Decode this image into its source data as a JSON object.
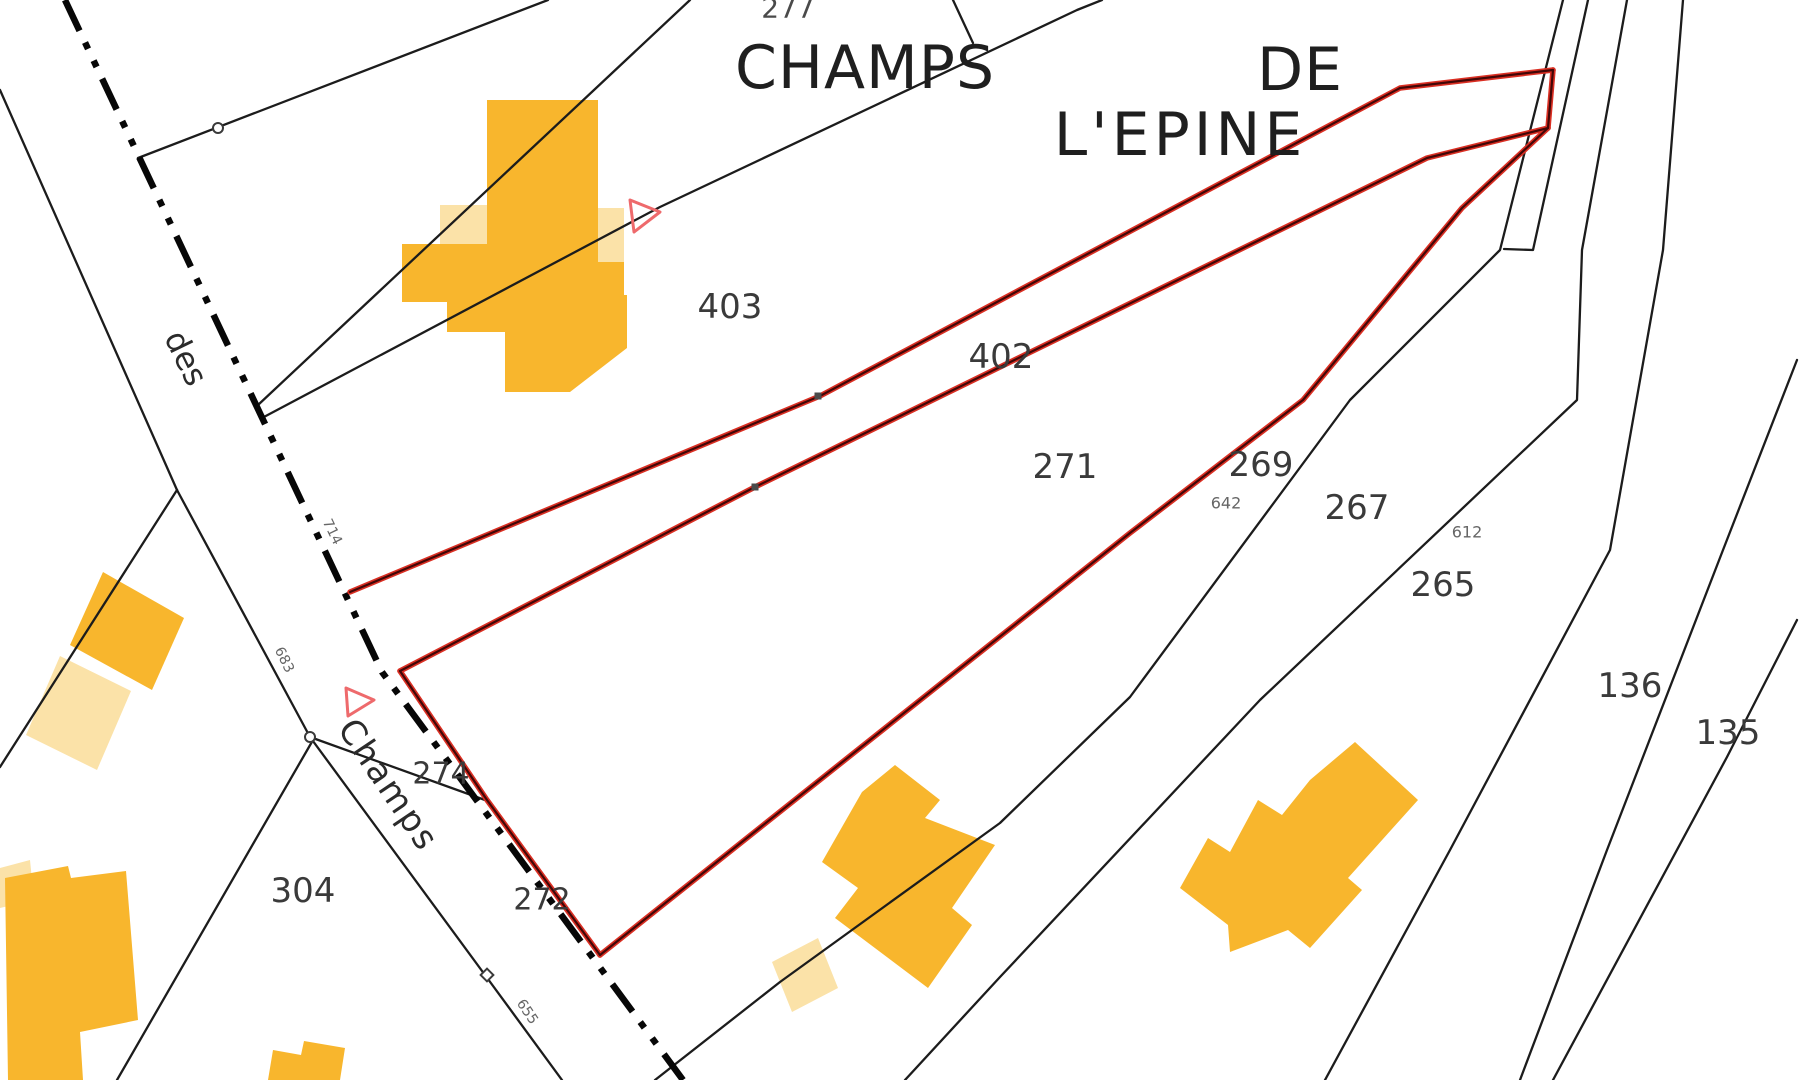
{
  "map": {
    "type": "cadastral-parcel-map",
    "canvas": {
      "width": 1799,
      "height": 1080,
      "background": "#ffffff"
    },
    "colors": {
      "parcel_line": "#1c1c1c",
      "road_dash": "#070707",
      "selected_outer": "#da2f23",
      "selected_inner": "#420707",
      "building_dark": "#F8B62D",
      "building_light": "#FBE2A8",
      "survey_marker": "#ee6a6c",
      "vertex_marker": "#3a3a3a",
      "place_label": "#1f1f1f",
      "parcel_label": "#3a3a3a",
      "ref_label": "#666666"
    },
    "place_labels": [
      {
        "name": "place-label-277",
        "text": "277",
        "x": 788,
        "y": 8,
        "size": 28,
        "color": "#4a4a4a"
      },
      {
        "name": "place-label-champs",
        "text": "CHAMPS",
        "x": 865,
        "y": 68,
        "size": 60,
        "ls": 1,
        "color": "#1f1f1f"
      },
      {
        "name": "place-label-de",
        "text": "DE",
        "x": 1300,
        "y": 70,
        "size": 60,
        "ls": 1,
        "color": "#1f1f1f"
      },
      {
        "name": "place-label-lepine",
        "text": "L'EPINE",
        "x": 1180,
        "y": 135,
        "size": 60,
        "ls": 4,
        "color": "#1f1f1f"
      }
    ],
    "parcel_labels": [
      {
        "name": "parcel-label-403",
        "text": "403",
        "x": 730,
        "y": 307,
        "size": 34
      },
      {
        "name": "parcel-label-402",
        "text": "402",
        "x": 1001,
        "y": 357,
        "size": 34
      },
      {
        "name": "parcel-label-271",
        "text": "271",
        "x": 1065,
        "y": 467,
        "size": 34
      },
      {
        "name": "parcel-label-269",
        "text": "269",
        "x": 1261,
        "y": 465,
        "size": 34
      },
      {
        "name": "parcel-label-267",
        "text": "267",
        "x": 1357,
        "y": 508,
        "size": 34
      },
      {
        "name": "parcel-label-265",
        "text": "265",
        "x": 1443,
        "y": 585,
        "size": 34
      },
      {
        "name": "parcel-label-136",
        "text": "136",
        "x": 1630,
        "y": 686,
        "size": 34
      },
      {
        "name": "parcel-label-135",
        "text": "135",
        "x": 1728,
        "y": 733,
        "size": 34
      },
      {
        "name": "parcel-label-304",
        "text": "304",
        "x": 303,
        "y": 891,
        "size": 34
      },
      {
        "name": "parcel-label-274",
        "text": "274",
        "x": 441,
        "y": 774,
        "size": 30
      },
      {
        "name": "parcel-label-272",
        "text": "272",
        "x": 542,
        "y": 900,
        "size": 30
      }
    ],
    "ref_labels": [
      {
        "name": "ref-label-642",
        "text": "642",
        "x": 1226,
        "y": 503,
        "size": 16,
        "rot": 0
      },
      {
        "name": "ref-label-612",
        "text": "612",
        "x": 1467,
        "y": 532,
        "size": 16,
        "rot": 0
      },
      {
        "name": "ref-label-714",
        "text": "714",
        "x": 332,
        "y": 532,
        "size": 14,
        "rot": 64
      },
      {
        "name": "ref-label-683",
        "text": "683",
        "x": 284,
        "y": 660,
        "size": 14,
        "rot": 64
      },
      {
        "name": "ref-label-655",
        "text": "655",
        "x": 527,
        "y": 1012,
        "size": 14,
        "rot": 56
      }
    ],
    "road_labels": [
      {
        "name": "road-label-des",
        "text": "des",
        "x": 186,
        "y": 358,
        "size": 32,
        "rot": 64,
        "color": "#2b2b2b"
      },
      {
        "name": "road-label-champs",
        "text": "Champs",
        "x": 388,
        "y": 785,
        "size": 34,
        "rot": 56,
        "color": "#2b2b2b",
        "ls": 2
      }
    ],
    "geometry": {
      "road_centerline": {
        "points": [
          [
            65,
            0
          ],
          [
            382,
            672
          ],
          [
            683,
            1080
          ]
        ],
        "width": 6.5,
        "dash": "34 13 7 13 7 13"
      },
      "parcel_lines": [
        [
          [
            0,
            90
          ],
          [
            177,
            490
          ]
        ],
        [
          [
            177,
            490
          ],
          [
            0,
            767
          ]
        ],
        [
          [
            177,
            490
          ],
          [
            310,
            737
          ],
          [
            485,
            975
          ],
          [
            562,
            1080
          ]
        ],
        [
          [
            313,
            740
          ],
          [
            117,
            1080
          ]
        ],
        [
          [
            310,
            737
          ],
          [
            485,
            800
          ]
        ],
        [
          [
            138,
            158
          ],
          [
            548,
            0
          ]
        ],
        [
          [
            258,
            405
          ],
          [
            690,
            0
          ]
        ],
        [
          [
            262,
            418
          ],
          [
            660,
            207
          ],
          [
            1077,
            10
          ],
          [
            1102,
            0
          ]
        ],
        [
          [
            953,
            0
          ],
          [
            973,
            43
          ]
        ],
        [
          [
            1563,
            0
          ],
          [
            1500,
            250
          ],
          [
            1350,
            400
          ],
          [
            1130,
            697
          ],
          [
            1000,
            823
          ],
          [
            780,
            982
          ],
          [
            655,
            1080
          ]
        ],
        [
          [
            1588,
            0
          ],
          [
            1533,
            250
          ],
          [
            1504,
            249
          ]
        ],
        [
          [
            1627,
            0
          ],
          [
            1582,
            250
          ],
          [
            1577,
            400
          ],
          [
            1260,
            700
          ],
          [
            1000,
            977
          ],
          [
            905,
            1080
          ]
        ],
        [
          [
            1683,
            0
          ],
          [
            1663,
            250
          ],
          [
            1610,
            550
          ],
          [
            1450,
            850
          ],
          [
            1325,
            1080
          ]
        ],
        [
          [
            1797,
            360
          ],
          [
            1723,
            550
          ],
          [
            1607,
            850
          ],
          [
            1520,
            1080
          ]
        ],
        [
          [
            1797,
            620
          ],
          [
            1727,
            757
          ],
          [
            1553,
            1080
          ]
        ]
      ],
      "selected_parcel_outline": [
        [
          [
            350,
            592
          ],
          [
            820,
            396
          ],
          [
            1400,
            88
          ],
          [
            1553,
            70
          ]
        ],
        [
          [
            1553,
            70
          ],
          [
            1548,
            128
          ]
        ],
        [
          [
            1548,
            128
          ],
          [
            1427,
            158
          ],
          [
            755,
            487
          ],
          [
            400,
            671
          ]
        ],
        [
          [
            400,
            671
          ],
          [
            487,
            800
          ],
          [
            600,
            955
          ]
        ],
        [
          [
            600,
            955
          ],
          [
            1130,
            533
          ],
          [
            1303,
            400
          ],
          [
            1462,
            208
          ],
          [
            1548,
            128
          ]
        ]
      ],
      "buildings": [
        {
          "name": "building-top-annex-left",
          "shade": "light",
          "points": [
            [
              440,
              205
            ],
            [
              488,
              205
            ],
            [
              488,
              245
            ],
            [
              440,
              245
            ]
          ]
        },
        {
          "name": "building-top-annex-right",
          "shade": "light",
          "points": [
            [
              598,
              208
            ],
            [
              624,
              208
            ],
            [
              624,
              262
            ],
            [
              598,
              262
            ]
          ]
        },
        {
          "name": "building-top-main",
          "shade": "dark",
          "points": [
            [
              487,
              100
            ],
            [
              598,
              100
            ],
            [
              598,
              262
            ],
            [
              624,
              262
            ],
            [
              624,
              295
            ],
            [
              627,
              295
            ],
            [
              627,
              348
            ],
            [
              570,
              392
            ],
            [
              505,
              392
            ],
            [
              505,
              332
            ],
            [
              447,
              332
            ],
            [
              447,
              302
            ],
            [
              402,
              302
            ],
            [
              402,
              244
            ],
            [
              487,
              244
            ]
          ]
        },
        {
          "name": "building-west-upper",
          "shade": "dark",
          "points": [
            [
              103,
              572
            ],
            [
              184,
              618
            ],
            [
              152,
              690
            ],
            [
              70,
              645
            ]
          ]
        },
        {
          "name": "building-west-lower",
          "shade": "light",
          "points": [
            [
              60,
              656
            ],
            [
              131,
              691
            ],
            [
              97,
              770
            ],
            [
              26,
              735
            ]
          ]
        },
        {
          "name": "building-southwest-annex",
          "shade": "light",
          "points": [
            [
              0,
              868
            ],
            [
              30,
              860
            ],
            [
              34,
              900
            ],
            [
              0,
              908
            ]
          ]
        },
        {
          "name": "building-southwest-main",
          "shade": "dark",
          "points": [
            [
              5,
              878
            ],
            [
              68,
              866
            ],
            [
              71,
              878
            ],
            [
              126,
              871
            ],
            [
              138,
              1020
            ],
            [
              80,
              1032
            ],
            [
              83,
              1080
            ],
            [
              8,
              1080
            ]
          ]
        },
        {
          "name": "building-bottom-small",
          "shade": "dark",
          "points": [
            [
              268,
              1080
            ],
            [
              273,
              1050
            ],
            [
              301,
              1055
            ],
            [
              304,
              1041
            ],
            [
              345,
              1048
            ],
            [
              340,
              1080
            ]
          ]
        },
        {
          "name": "building-center-annex",
          "shade": "light",
          "points": [
            [
              772,
              962
            ],
            [
              818,
              938
            ],
            [
              838,
              988
            ],
            [
              792,
              1012
            ]
          ]
        },
        {
          "name": "building-center-main",
          "shade": "dark",
          "points": [
            [
              862,
              792
            ],
            [
              895,
              765
            ],
            [
              940,
              800
            ],
            [
              925,
              818
            ],
            [
              995,
              845
            ],
            [
              952,
              908
            ],
            [
              972,
              925
            ],
            [
              928,
              988
            ],
            [
              835,
              918
            ],
            [
              858,
              888
            ],
            [
              822,
              862
            ]
          ]
        },
        {
          "name": "building-east-main",
          "shade": "dark",
          "points": [
            [
              1355,
              742
            ],
            [
              1418,
              800
            ],
            [
              1348,
              878
            ],
            [
              1362,
              890
            ],
            [
              1310,
              948
            ],
            [
              1288,
              930
            ],
            [
              1230,
              952
            ],
            [
              1228,
              925
            ],
            [
              1180,
              888
            ],
            [
              1208,
              838
            ],
            [
              1230,
              852
            ],
            [
              1258,
              800
            ],
            [
              1282,
              815
            ],
            [
              1310,
              780
            ]
          ]
        }
      ],
      "markers": {
        "survey_triangles": [
          {
            "name": "survey-triangle-east",
            "points": [
              [
                630,
                200
              ],
              [
                660,
                212
              ],
              [
                634,
                232
              ]
            ]
          },
          {
            "name": "survey-triangle-west",
            "points": [
              [
                346,
                688
              ],
              [
                374,
                700
              ],
              [
                348,
                716
              ]
            ]
          }
        ],
        "vertex_circles": [
          [
            218,
            128
          ],
          [
            310,
            737
          ]
        ],
        "vertex_diamonds": [
          [
            487,
            975
          ]
        ],
        "boundary_squares": [
          [
            818,
            396
          ],
          [
            755,
            487
          ]
        ]
      }
    }
  }
}
